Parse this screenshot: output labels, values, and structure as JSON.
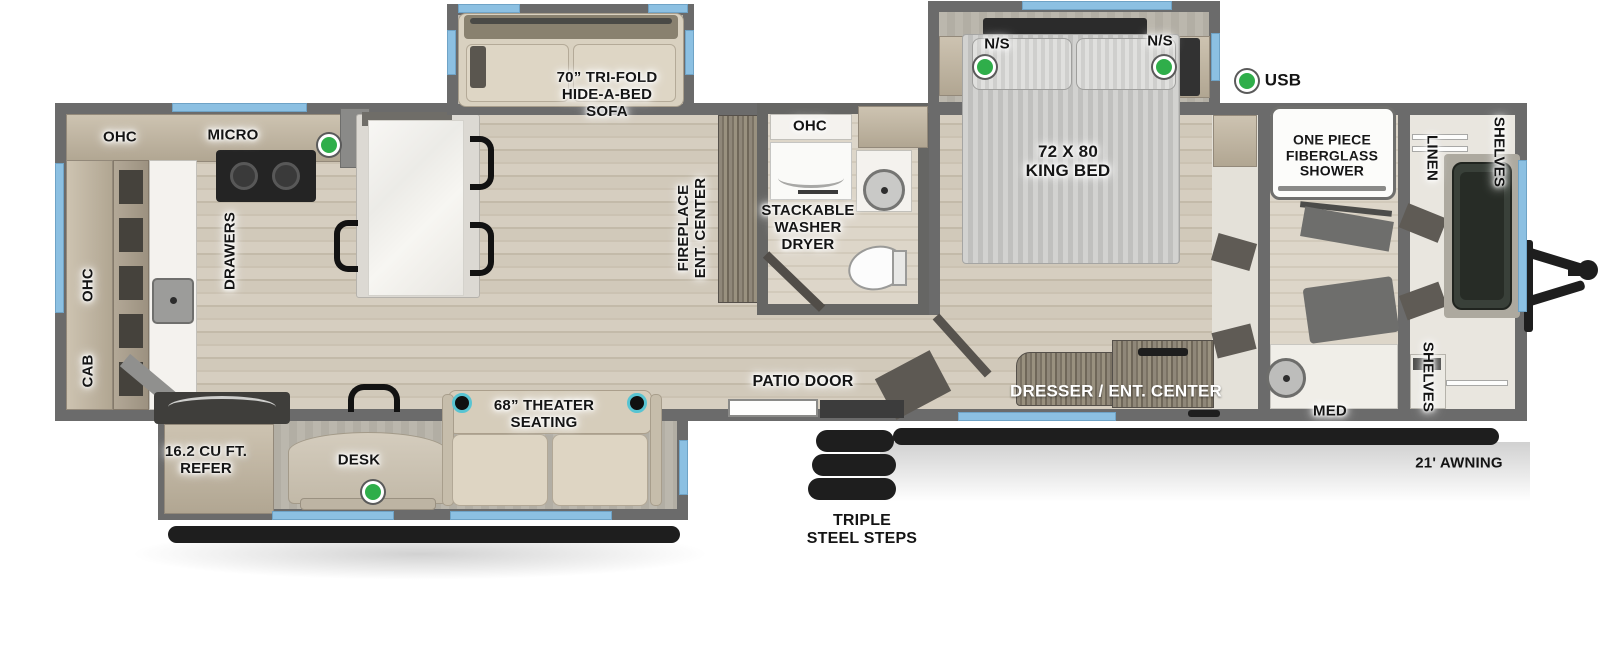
{
  "legend": {
    "usb": "USB"
  },
  "kitchen": {
    "ohc_top": "OHC",
    "micro": "MICRO",
    "ohc_side": "OHC",
    "cab": "CAB",
    "drawers": "DRAWERS"
  },
  "living": {
    "sofa": "70” TRI-FOLD\nHIDE-A-BED\nSOFA",
    "fireplace": "FIREPLACE\nENT. CENTER",
    "theater": "68” THEATER\nSEATING",
    "desk": "DESK",
    "refer": "16.2 CU FT.\nREFER"
  },
  "mid_bath": {
    "ohc": "OHC",
    "washer": "STACKABLE\nWASHER\nDRYER"
  },
  "bedroom": {
    "bed": "72 X 80\nKING BED",
    "ns_left": "N/S",
    "ns_right": "N/S",
    "dresser": "DRESSER / ENT. CENTER"
  },
  "front_bath": {
    "shower": "ONE PIECE\nFIBERGLASS\nSHOWER",
    "med": "MED"
  },
  "closet": {
    "linen": "LINEN",
    "shelves_top": "SHELVES",
    "shelves_bottom": "SHELVES"
  },
  "exterior": {
    "patio_door": "PATIO DOOR",
    "steps": "TRIPLE\nSTEEL STEPS",
    "awning": "21' AWNING"
  },
  "colors": {
    "accent_green": "#2fae4a",
    "window_blue": "#8cc0e2",
    "wall_gray": "#6b6b6b"
  }
}
